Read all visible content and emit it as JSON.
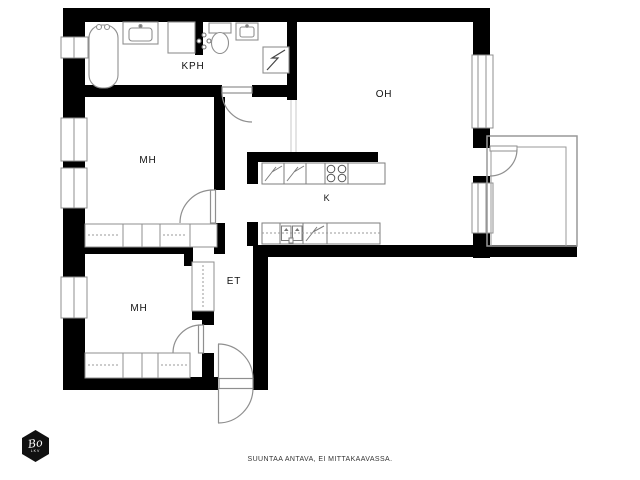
{
  "plan": {
    "rooms": [
      {
        "id": "kph",
        "label": "KPH"
      },
      {
        "id": "oh",
        "label": "OH"
      },
      {
        "id": "mh1",
        "label": "MH"
      },
      {
        "id": "k",
        "label": "K"
      },
      {
        "id": "et",
        "label": "ET"
      },
      {
        "id": "mh2",
        "label": "MH"
      }
    ],
    "fixtures": [
      "bathtub",
      "vanity-sink",
      "washing-machine",
      "water-valve",
      "toilet",
      "hand-sink",
      "electrical-cabinet",
      "refrigerator",
      "freezer",
      "stove",
      "kitchen-sink",
      "dishwasher",
      "wardrobe",
      "hall-closet",
      "balcony",
      "window",
      "door"
    ]
  },
  "footer": {
    "disclaimer": "SUUNTAA ANTAVA, EI MITTAKAAVASSA."
  },
  "logo": {
    "brand": "Bo",
    "subtext": "LKV"
  },
  "colors": {
    "wall": "#000000",
    "fixture_outline": "#8f8f8f",
    "background": "#ffffff"
  }
}
